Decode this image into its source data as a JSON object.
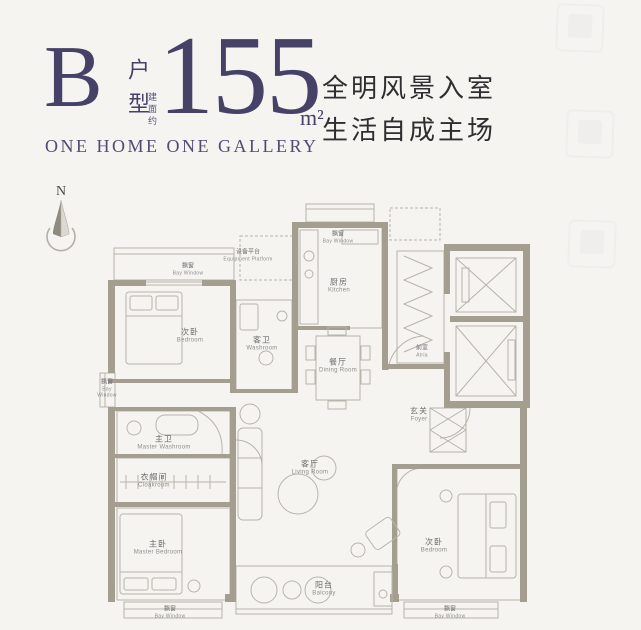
{
  "header": {
    "plan_letter": "B",
    "plan_type": "户型",
    "area_label": "建面约",
    "area_value": "155",
    "area_unit": "m²",
    "subtitle": "ONE HOME ONE GALLERY",
    "tagline": [
      "全明风景入室",
      "生活自成主场"
    ]
  },
  "compass": {
    "north": "N"
  },
  "rooms": {
    "bay_tl": {
      "zh": "飘窗",
      "en": "Bay Window"
    },
    "equipment": {
      "zh": "设备平台",
      "en": "Equipment Platform"
    },
    "bay_kitchen": {
      "zh": "飘窗",
      "en": "Bay Window"
    },
    "bedroom_top": {
      "zh": "次卧",
      "en": "Bedroom"
    },
    "washroom": {
      "zh": "客卫",
      "en": "Washroom"
    },
    "kitchen": {
      "zh": "厨房",
      "en": "Kitchen"
    },
    "dining": {
      "zh": "餐厅",
      "en": "Dining Room"
    },
    "atria": {
      "zh": "前室",
      "en": "Atria"
    },
    "foyer": {
      "zh": "玄关",
      "en": "Foyer"
    },
    "bay_left": {
      "zh": "飘窗",
      "en": "Bay Window"
    },
    "master_wash": {
      "zh": "主卫",
      "en": "Master Washroom"
    },
    "cloakroom": {
      "zh": "衣帽间",
      "en": "Cloakroom"
    },
    "master_bed": {
      "zh": "主卧",
      "en": "Master Bedroom"
    },
    "living": {
      "zh": "客厅",
      "en": "Living Room"
    },
    "bedroom_right": {
      "zh": "次卧",
      "en": "Bedroom"
    },
    "balcony": {
      "zh": "阳台",
      "en": "Balcony"
    },
    "bay_bl": {
      "zh": "飘窗",
      "en": "Bay Window"
    },
    "bay_br": {
      "zh": "飘窗",
      "en": "Bay Window"
    }
  },
  "colors": {
    "accent": "#454167",
    "wall": "#a49e91",
    "line": "#b7b3a9",
    "background": "#f5f4f1",
    "text_muted": "#6e6e6e"
  }
}
